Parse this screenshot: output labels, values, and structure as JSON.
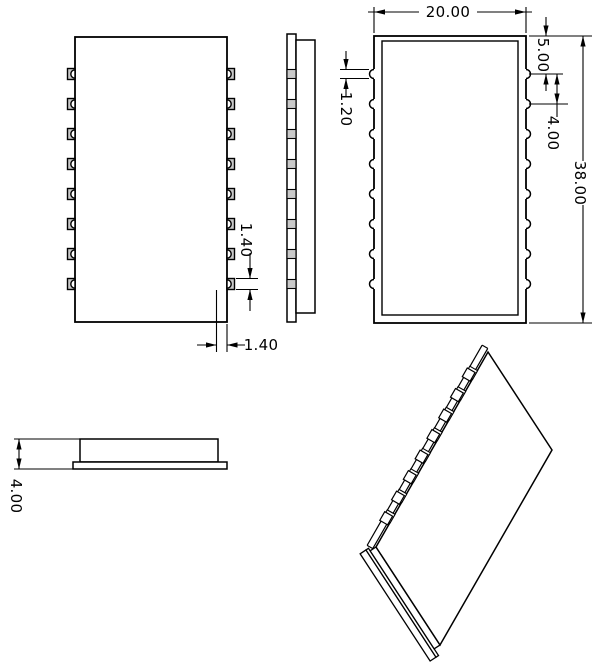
{
  "drawing": {
    "dimensions": {
      "overall_width": "20.00",
      "top_edge_to_first_notch": "5.00",
      "notch_pitch": "4.00",
      "overall_height": "38.00",
      "notch_slot_width": "1.20",
      "notch_height": "1.40",
      "notch_depth": "1.40",
      "overall_thickness": "4.00"
    }
  }
}
